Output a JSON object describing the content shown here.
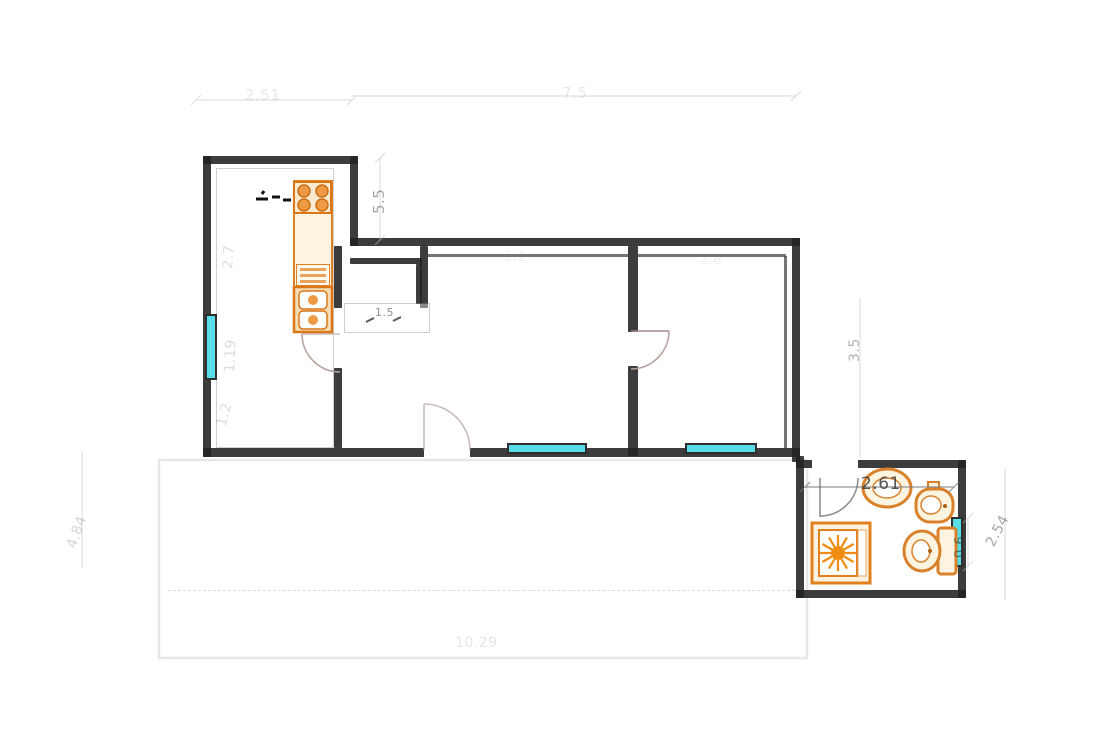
{
  "title": "Apartment floor plan drawing",
  "colors": {
    "wall": "#222222",
    "window_fill": "#58dde6",
    "fixture_stroke": "#dd8026",
    "fixture_fill": "#fdf3e1",
    "fixture_accent": "#ee9232",
    "door_arc": "#b3a09b",
    "dim_text": "#555555",
    "terrace_outline": "#c9c9c9"
  },
  "dims": {
    "top_kitchen": {
      "value": "2.51"
    },
    "top_wing": {
      "value": "7.5"
    },
    "kitchen_offset": {
      "value": "5.5"
    },
    "kitchen_upper": {
      "value": "2.7"
    },
    "kitchen_window": {
      "value": "1.19"
    },
    "kitchen_lower": {
      "value": "1.2"
    },
    "corridor_niche": {
      "value": "1.5"
    },
    "outer_left": {
      "value": "4.84"
    },
    "living_top": {
      "value": "3.2"
    },
    "bedroom_top": {
      "value": "2.6"
    },
    "wing_right": {
      "value": "3.5"
    },
    "bath_width": {
      "value": "2.61"
    },
    "bath_window": {
      "value": "0.6"
    },
    "outer_right": {
      "value": "2.54"
    },
    "bottom_total": {
      "value": "10.29"
    }
  },
  "icons": {
    "stove": "stove-4-burners",
    "counter": "kitchen-counter",
    "appliance": "dishwasher",
    "sink": "double-sink",
    "dish_rack": "dish-rack",
    "washbasin": "washbasin",
    "bidet": "bidet",
    "toilet": "toilet",
    "shower": "shower-tray",
    "windows": "window-glazing",
    "doors": "door-swing"
  }
}
